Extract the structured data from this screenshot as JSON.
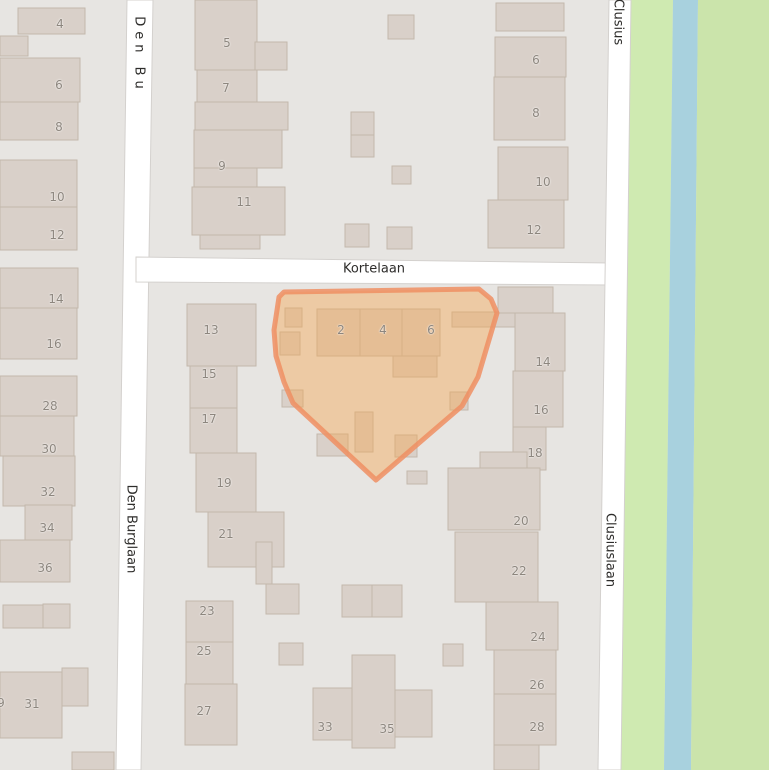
{
  "map": {
    "width": 769,
    "height": 770,
    "colors": {
      "background": "#e7e5e2",
      "road_fill": "#ffffff",
      "road_casing": "#d4d1ce",
      "building_fill": "#d9d0c9",
      "building_stroke": "#c3b8ac",
      "grass_left": "#cfeab1",
      "grass_right": "#cbe4ab",
      "water": "#a8d1de",
      "highlight_fill": "#f5a44e",
      "highlight_stroke": "#ef8f63",
      "house_number_color": "#8d867e",
      "street_label_color": "#2e2d2b"
    },
    "zones": [
      {
        "name": "grass-west-bank",
        "color": "grass_left",
        "points": [
          [
            630,
            0
          ],
          [
            673,
            0
          ],
          [
            664,
            770
          ],
          [
            621,
            770
          ]
        ]
      },
      {
        "name": "canal",
        "color": "water",
        "points": [
          [
            673,
            0
          ],
          [
            698,
            0
          ],
          [
            691,
            770
          ],
          [
            664,
            770
          ]
        ]
      },
      {
        "name": "grass-east-bank",
        "color": "grass_right",
        "points": [
          [
            698,
            0
          ],
          [
            769,
            0
          ],
          [
            769,
            770
          ],
          [
            691,
            770
          ]
        ]
      }
    ],
    "roads": [
      {
        "name": "den-burglaan",
        "points": [
          [
            127,
            0
          ],
          [
            153,
            0
          ],
          [
            141,
            770
          ],
          [
            116,
            770
          ]
        ]
      },
      {
        "name": "kortelaan",
        "points": [
          [
            136,
            257
          ],
          [
            611,
            263
          ],
          [
            611,
            285
          ],
          [
            136,
            282
          ]
        ]
      },
      {
        "name": "clusiuslaan",
        "points": [
          [
            609,
            0
          ],
          [
            631,
            0
          ],
          [
            621,
            770
          ],
          [
            598,
            770
          ]
        ]
      }
    ],
    "buildings": [
      [
        18,
        8,
        67,
        26
      ],
      [
        0,
        36,
        28,
        20
      ],
      [
        0,
        58,
        80,
        44
      ],
      [
        0,
        102,
        78,
        38
      ],
      [
        0,
        160,
        77,
        47
      ],
      [
        0,
        207,
        77,
        43
      ],
      [
        0,
        268,
        78,
        40
      ],
      [
        0,
        308,
        77,
        51
      ],
      [
        0,
        376,
        77,
        40
      ],
      [
        0,
        416,
        74,
        40
      ],
      [
        3,
        456,
        72,
        50
      ],
      [
        25,
        505,
        47,
        35
      ],
      [
        0,
        540,
        70,
        42
      ],
      [
        3,
        605,
        40,
        23
      ],
      [
        43,
        604,
        27,
        24
      ],
      [
        0,
        672,
        62,
        66
      ],
      [
        62,
        668,
        26,
        38
      ],
      [
        72,
        752,
        42,
        18
      ],
      [
        195,
        0,
        62,
        70
      ],
      [
        255,
        42,
        32,
        28
      ],
      [
        197,
        70,
        60,
        36
      ],
      [
        195,
        102,
        93,
        28
      ],
      [
        194,
        130,
        88,
        38
      ],
      [
        194,
        168,
        63,
        20
      ],
      [
        192,
        187,
        93,
        48
      ],
      [
        200,
        235,
        60,
        14
      ],
      [
        388,
        15,
        26,
        24
      ],
      [
        351,
        112,
        23,
        23
      ],
      [
        351,
        135,
        23,
        22
      ],
      [
        392,
        166,
        19,
        18
      ],
      [
        345,
        224,
        24,
        23
      ],
      [
        387,
        227,
        25,
        22
      ],
      [
        496,
        3,
        68,
        28
      ],
      [
        495,
        37,
        71,
        40
      ],
      [
        494,
        77,
        71,
        63
      ],
      [
        498,
        147,
        70,
        53
      ],
      [
        488,
        200,
        76,
        48
      ],
      [
        187,
        304,
        69,
        62
      ],
      [
        190,
        366,
        47,
        42
      ],
      [
        190,
        408,
        47,
        45
      ],
      [
        196,
        453,
        60,
        59
      ],
      [
        208,
        512,
        76,
        55
      ],
      [
        256,
        542,
        16,
        42
      ],
      [
        266,
        584,
        33,
        30
      ],
      [
        186,
        601,
        47,
        41
      ],
      [
        186,
        642,
        47,
        42
      ],
      [
        185,
        684,
        52,
        61
      ],
      [
        342,
        585,
        30,
        32
      ],
      [
        372,
        585,
        30,
        32
      ],
      [
        279,
        643,
        24,
        22
      ],
      [
        443,
        644,
        20,
        22
      ],
      [
        352,
        655,
        43,
        93
      ],
      [
        313,
        688,
        39,
        52
      ],
      [
        395,
        690,
        37,
        47
      ],
      [
        407,
        471,
        20,
        13
      ],
      [
        317,
        309,
        43,
        47
      ],
      [
        360,
        309,
        42,
        47
      ],
      [
        402,
        309,
        38,
        47
      ],
      [
        393,
        356,
        44,
        21
      ],
      [
        285,
        308,
        17,
        19
      ],
      [
        280,
        332,
        20,
        23
      ],
      [
        452,
        312,
        64,
        15
      ],
      [
        282,
        390,
        21,
        17
      ],
      [
        450,
        392,
        18,
        18
      ],
      [
        355,
        412,
        18,
        40
      ],
      [
        317,
        434,
        31,
        22
      ],
      [
        395,
        435,
        22,
        22
      ],
      [
        498,
        287,
        55,
        26
      ],
      [
        515,
        313,
        50,
        58
      ],
      [
        513,
        371,
        50,
        56
      ],
      [
        513,
        427,
        33,
        43
      ],
      [
        480,
        452,
        47,
        18
      ],
      [
        448,
        468,
        92,
        62
      ],
      [
        455,
        532,
        83,
        70
      ],
      [
        486,
        602,
        72,
        48
      ],
      [
        494,
        650,
        62,
        44
      ],
      [
        494,
        694,
        62,
        51
      ],
      [
        494,
        745,
        45,
        25
      ]
    ],
    "highlight": {
      "name": "selected-parcel-kortelaan-2-4-6",
      "points": [
        [
          279,
          297
        ],
        [
          284,
          292
        ],
        [
          479,
          289
        ],
        [
          491,
          299
        ],
        [
          497,
          313
        ],
        [
          478,
          377
        ],
        [
          462,
          406
        ],
        [
          376,
          480
        ],
        [
          293,
          403
        ],
        [
          284,
          382
        ],
        [
          276,
          356
        ],
        [
          274,
          330
        ]
      ]
    },
    "house_numbers": [
      {
        "t": "4",
        "x": 60,
        "y": 24
      },
      {
        "t": "6",
        "x": 59,
        "y": 85
      },
      {
        "t": "8",
        "x": 59,
        "y": 127
      },
      {
        "t": "10",
        "x": 57,
        "y": 197
      },
      {
        "t": "12",
        "x": 57,
        "y": 235
      },
      {
        "t": "14",
        "x": 56,
        "y": 299
      },
      {
        "t": "16",
        "x": 54,
        "y": 344
      },
      {
        "t": "28",
        "x": 50,
        "y": 406
      },
      {
        "t": "30",
        "x": 49,
        "y": 449
      },
      {
        "t": "32",
        "x": 48,
        "y": 492
      },
      {
        "t": "34",
        "x": 47,
        "y": 528
      },
      {
        "t": "36",
        "x": 45,
        "y": 568
      },
      {
        "t": "9",
        "x": 1,
        "y": 703
      },
      {
        "t": "31",
        "x": 32,
        "y": 704
      },
      {
        "t": "5",
        "x": 227,
        "y": 43
      },
      {
        "t": "7",
        "x": 226,
        "y": 88
      },
      {
        "t": "9",
        "x": 222,
        "y": 166
      },
      {
        "t": "11",
        "x": 244,
        "y": 202
      },
      {
        "t": "6",
        "x": 536,
        "y": 60
      },
      {
        "t": "8",
        "x": 536,
        "y": 113
      },
      {
        "t": "10",
        "x": 543,
        "y": 182
      },
      {
        "t": "12",
        "x": 534,
        "y": 230
      },
      {
        "t": "13",
        "x": 211,
        "y": 330
      },
      {
        "t": "15",
        "x": 209,
        "y": 374
      },
      {
        "t": "17",
        "x": 209,
        "y": 419
      },
      {
        "t": "19",
        "x": 224,
        "y": 483
      },
      {
        "t": "21",
        "x": 226,
        "y": 534
      },
      {
        "t": "23",
        "x": 207,
        "y": 611
      },
      {
        "t": "25",
        "x": 204,
        "y": 651
      },
      {
        "t": "27",
        "x": 204,
        "y": 711
      },
      {
        "t": "14",
        "x": 543,
        "y": 362
      },
      {
        "t": "16",
        "x": 541,
        "y": 410
      },
      {
        "t": "18",
        "x": 535,
        "y": 453
      },
      {
        "t": "20",
        "x": 521,
        "y": 521
      },
      {
        "t": "22",
        "x": 519,
        "y": 571
      },
      {
        "t": "24",
        "x": 538,
        "y": 637
      },
      {
        "t": "26",
        "x": 537,
        "y": 685
      },
      {
        "t": "28",
        "x": 537,
        "y": 727
      },
      {
        "t": "33",
        "x": 325,
        "y": 727
      },
      {
        "t": "35",
        "x": 387,
        "y": 729
      },
      {
        "t": "2",
        "x": 341,
        "y": 330
      },
      {
        "t": "4",
        "x": 383,
        "y": 330
      },
      {
        "t": "6",
        "x": 431,
        "y": 330
      }
    ],
    "street_labels": [
      {
        "text": "Den Bu",
        "x": 139,
        "y": 55,
        "vertical": true,
        "spacing": 5
      },
      {
        "text": "Clusius",
        "x": 618,
        "y": 22,
        "vertical": true,
        "spacing": 0
      },
      {
        "text": "Kortelaan",
        "x": 374,
        "y": 269,
        "vertical": false,
        "spacing": 0
      },
      {
        "text": "Den Burglaan",
        "x": 131,
        "y": 529,
        "vertical": true,
        "spacing": 0
      },
      {
        "text": "Clusiuslaan",
        "x": 610,
        "y": 550,
        "vertical": true,
        "spacing": 0
      }
    ]
  }
}
